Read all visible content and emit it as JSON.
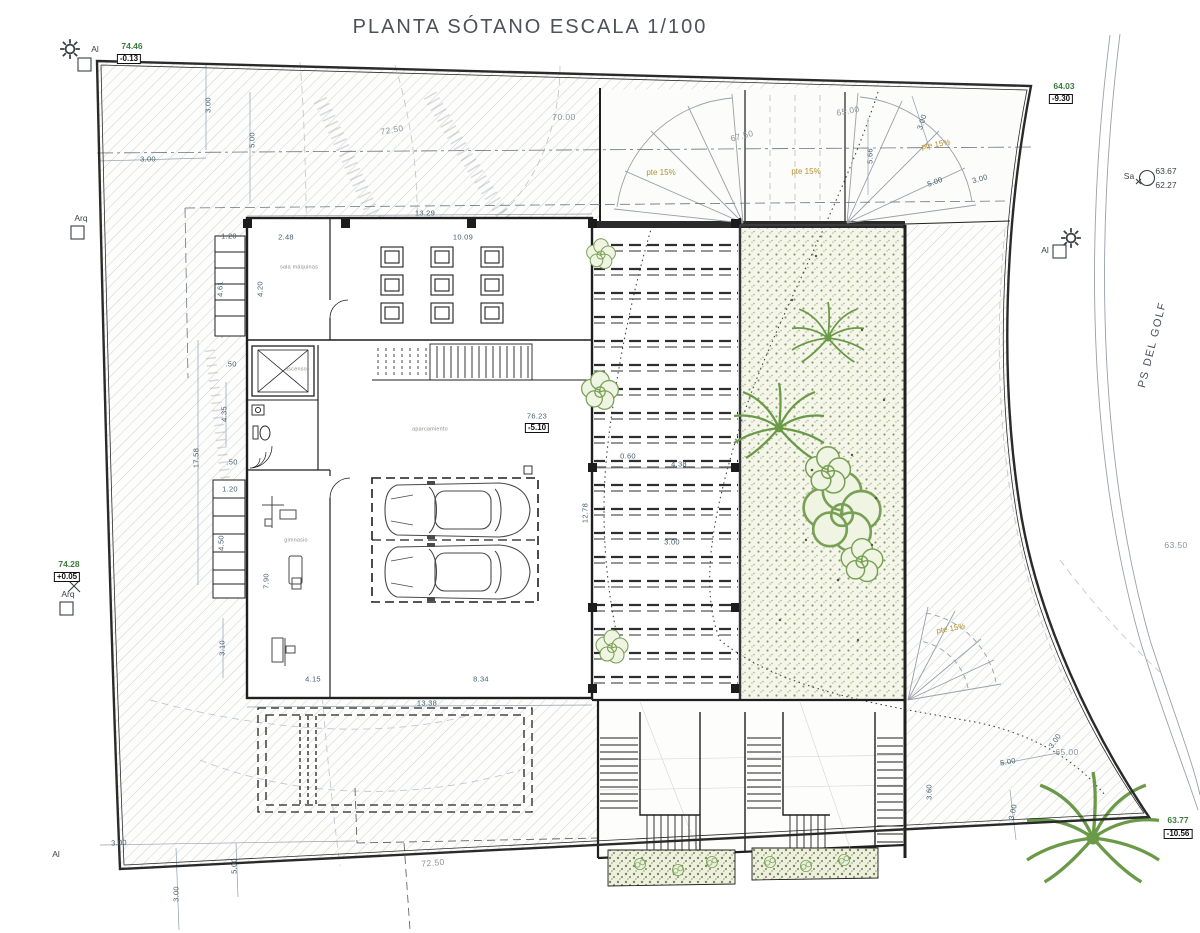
{
  "title": "PLANTA SÓTANO ESCALA 1/100",
  "palette": {
    "level_green": "#3c7a3c",
    "slope_orange": "#b3922f",
    "dim_blue": "#44606f",
    "contour_gray": "#8d929a",
    "line_dark": "#1f1f1f",
    "vegetation_green": "#6a9a48",
    "gravel_tone": "#8f9868"
  },
  "symbols": {
    "sun": "sun-icon",
    "survey_point": "survey-point-icon",
    "tree": "tree-icon",
    "palm": "palm-tree-icon",
    "car": "car-icon"
  },
  "annotations": [
    {
      "t": "74.46",
      "x": 132,
      "y": 46,
      "r": 0,
      "c": "level"
    },
    {
      "t": "-0.13",
      "x": 129,
      "y": 59,
      "r": 0,
      "c": "levelbox"
    },
    {
      "t": "Al",
      "x": 95,
      "y": 49,
      "r": 0,
      "c": "marker"
    },
    {
      "t": "Arq",
      "x": 81,
      "y": 218,
      "r": 0,
      "c": "marker"
    },
    {
      "t": "74.28",
      "x": 69,
      "y": 564,
      "r": 0,
      "c": "level"
    },
    {
      "t": "+0.05",
      "x": 67,
      "y": 577,
      "r": 0,
      "c": "levelbox"
    },
    {
      "t": "Arq",
      "x": 68,
      "y": 594,
      "r": 0,
      "c": "marker"
    },
    {
      "t": "Al",
      "x": 56,
      "y": 854,
      "r": 0,
      "c": "marker"
    },
    {
      "t": "64.03",
      "x": 1064,
      "y": 86,
      "r": 0,
      "c": "level"
    },
    {
      "t": "-9.30",
      "x": 1061,
      "y": 99,
      "r": 0,
      "c": "levelbox"
    },
    {
      "t": "Sa",
      "x": 1129,
      "y": 176,
      "r": 0,
      "c": "marker"
    },
    {
      "t": "63.67",
      "x": 1166,
      "y": 171,
      "r": 0,
      "c": "marker"
    },
    {
      "t": "62.27",
      "x": 1166,
      "y": 185,
      "r": 0,
      "c": "marker"
    },
    {
      "t": "Al",
      "x": 1045,
      "y": 250,
      "r": 0,
      "c": "marker"
    },
    {
      "t": "63.77",
      "x": 1178,
      "y": 820,
      "r": 0,
      "c": "level"
    },
    {
      "t": "-10.56",
      "x": 1178,
      "y": 834,
      "r": 0,
      "c": "levelbox"
    },
    {
      "t": "PS DEL GOLF",
      "x": 1153,
      "y": 345,
      "r": -76,
      "c": "street"
    },
    {
      "t": "63.50",
      "x": 1176,
      "y": 545,
      "r": 0,
      "c": "contour"
    },
    {
      "t": "72.50",
      "x": 392,
      "y": 130,
      "r": -10,
      "c": "contour"
    },
    {
      "t": "70.00",
      "x": 564,
      "y": 117,
      "r": 0,
      "c": "contour"
    },
    {
      "t": "67.50",
      "x": 742,
      "y": 136,
      "r": -15,
      "c": "contour"
    },
    {
      "t": "65.00",
      "x": 848,
      "y": 111,
      "r": -10,
      "c": "contour"
    },
    {
      "t": "65.00",
      "x": 1067,
      "y": 752,
      "r": 0,
      "c": "contour"
    },
    {
      "t": "72.50",
      "x": 433,
      "y": 863,
      "r": -5,
      "c": "contour"
    },
    {
      "t": "pte 15%",
      "x": 661,
      "y": 173,
      "r": 0,
      "c": "pte"
    },
    {
      "t": "pte 15%",
      "x": 806,
      "y": 172,
      "r": 0,
      "c": "pte"
    },
    {
      "t": "pte 15%",
      "x": 936,
      "y": 145,
      "r": -10,
      "c": "pte"
    },
    {
      "t": "pte 15%",
      "x": 951,
      "y": 629,
      "r": -10,
      "c": "pte"
    },
    {
      "t": "3.00",
      "x": 208,
      "y": 105,
      "r": -90,
      "c": "dim"
    },
    {
      "t": "5.00",
      "x": 252,
      "y": 140,
      "r": -90,
      "c": "dim"
    },
    {
      "t": "3.00",
      "x": 148,
      "y": 159,
      "r": 0,
      "c": "dim"
    },
    {
      "t": "13.29",
      "x": 425,
      "y": 213,
      "r": 0,
      "c": "dim"
    },
    {
      "t": "1.20",
      "x": 229,
      "y": 236,
      "r": 0,
      "c": "dim"
    },
    {
      "t": "2.48",
      "x": 286,
      "y": 237,
      "r": 0,
      "c": "dim"
    },
    {
      "t": "10.09",
      "x": 463,
      "y": 237,
      "r": 0,
      "c": "dim"
    },
    {
      "t": "4.61",
      "x": 220,
      "y": 289,
      "r": -90,
      "c": "dim"
    },
    {
      "t": "4.20",
      "x": 260,
      "y": 289,
      "r": -90,
      "c": "dim"
    },
    {
      "t": ".50",
      "x": 231,
      "y": 364,
      "r": 0,
      "c": "dim"
    },
    {
      "t": "4.35",
      "x": 224,
      "y": 414,
      "r": -90,
      "c": "dim"
    },
    {
      "t": "17.58",
      "x": 196,
      "y": 458,
      "r": -90,
      "c": "dim"
    },
    {
      "t": ".50",
      "x": 232,
      "y": 462,
      "r": 0,
      "c": "dim"
    },
    {
      "t": "1.20",
      "x": 230,
      "y": 489,
      "r": 0,
      "c": "dim"
    },
    {
      "t": "4.50",
      "x": 221,
      "y": 543,
      "r": -90,
      "c": "dim"
    },
    {
      "t": "7.90",
      "x": 266,
      "y": 581,
      "r": -90,
      "c": "dim"
    },
    {
      "t": "3.10",
      "x": 222,
      "y": 648,
      "r": -90,
      "c": "dim"
    },
    {
      "t": "4.15",
      "x": 313,
      "y": 679,
      "r": 0,
      "c": "dim"
    },
    {
      "t": "8.34",
      "x": 481,
      "y": 679,
      "r": 0,
      "c": "dim"
    },
    {
      "t": "13.38",
      "x": 427,
      "y": 703,
      "r": 0,
      "c": "dim"
    },
    {
      "t": "76.23",
      "x": 537,
      "y": 416,
      "r": 0,
      "c": "dim"
    },
    {
      "t": "-5.10",
      "x": 537,
      "y": 428,
      "r": 0,
      "c": "levelbox"
    },
    {
      "t": "12.78",
      "x": 585,
      "y": 513,
      "r": -90,
      "c": "dim"
    },
    {
      "t": "0.60",
      "x": 628,
      "y": 456,
      "r": 0,
      "c": "dim"
    },
    {
      "t": "4.38",
      "x": 679,
      "y": 464,
      "r": 0,
      "c": "dim"
    },
    {
      "t": "3.00",
      "x": 672,
      "y": 542,
      "r": 0,
      "c": "dim"
    },
    {
      "t": "5.66",
      "x": 870,
      "y": 156,
      "r": -90,
      "c": "dim"
    },
    {
      "t": "3.00",
      "x": 922,
      "y": 122,
      "r": -72,
      "c": "dim"
    },
    {
      "t": "5.00",
      "x": 935,
      "y": 182,
      "r": -20,
      "c": "dim"
    },
    {
      "t": "3.00",
      "x": 980,
      "y": 179,
      "r": -15,
      "c": "dim"
    },
    {
      "t": "3.00",
      "x": 119,
      "y": 843,
      "r": -3,
      "c": "dim"
    },
    {
      "t": "3.00",
      "x": 176,
      "y": 894,
      "r": -90,
      "c": "dim"
    },
    {
      "t": "5.00",
      "x": 234,
      "y": 866,
      "r": -90,
      "c": "dim"
    },
    {
      "t": "3.00",
      "x": 1055,
      "y": 741,
      "r": -55,
      "c": "dim"
    },
    {
      "t": "5.00",
      "x": 1008,
      "y": 762,
      "r": -10,
      "c": "dim"
    },
    {
      "t": "3.00",
      "x": 1013,
      "y": 812,
      "r": -78,
      "c": "dim"
    },
    {
      "t": "3.60",
      "x": 929,
      "y": 792,
      "r": -90,
      "c": "dim"
    },
    {
      "t": "ascensor",
      "x": 297,
      "y": 370,
      "r": 0,
      "c": "room"
    },
    {
      "t": "sala máquinas",
      "x": 299,
      "y": 268,
      "r": 0,
      "c": "room"
    },
    {
      "t": "gimnasio",
      "x": 296,
      "y": 541,
      "r": 0,
      "c": "room"
    },
    {
      "t": "aparcamiento",
      "x": 430,
      "y": 430,
      "r": 0,
      "c": "room"
    }
  ]
}
